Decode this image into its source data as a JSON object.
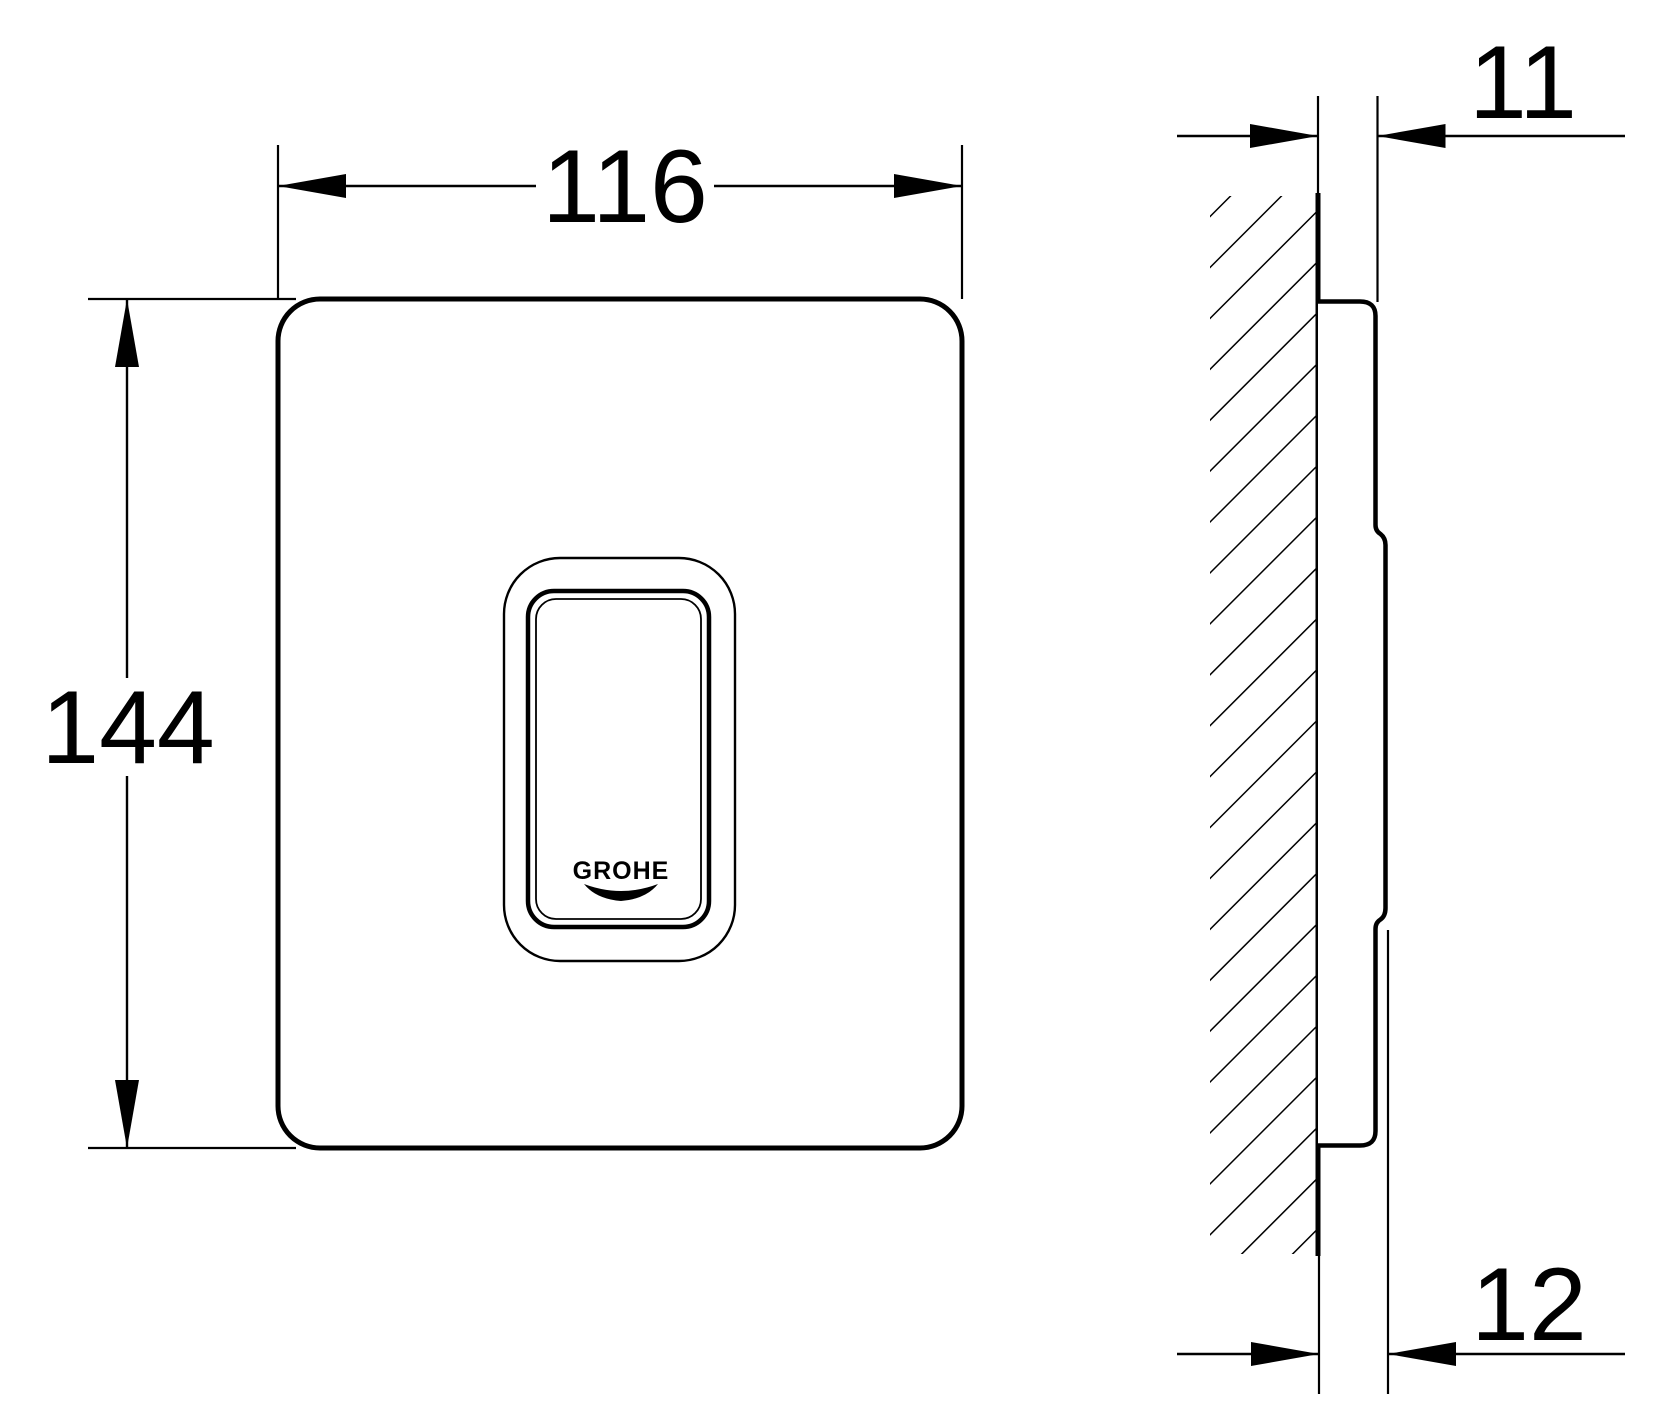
{
  "colors": {
    "background": "#ffffff",
    "line": "#000000"
  },
  "front_view": {
    "width_dimension": "116",
    "height_dimension": "144",
    "logo": "GROHE"
  },
  "side_view": {
    "plate_protrusion_dimension": "11",
    "total_depth_dimension": "12"
  }
}
